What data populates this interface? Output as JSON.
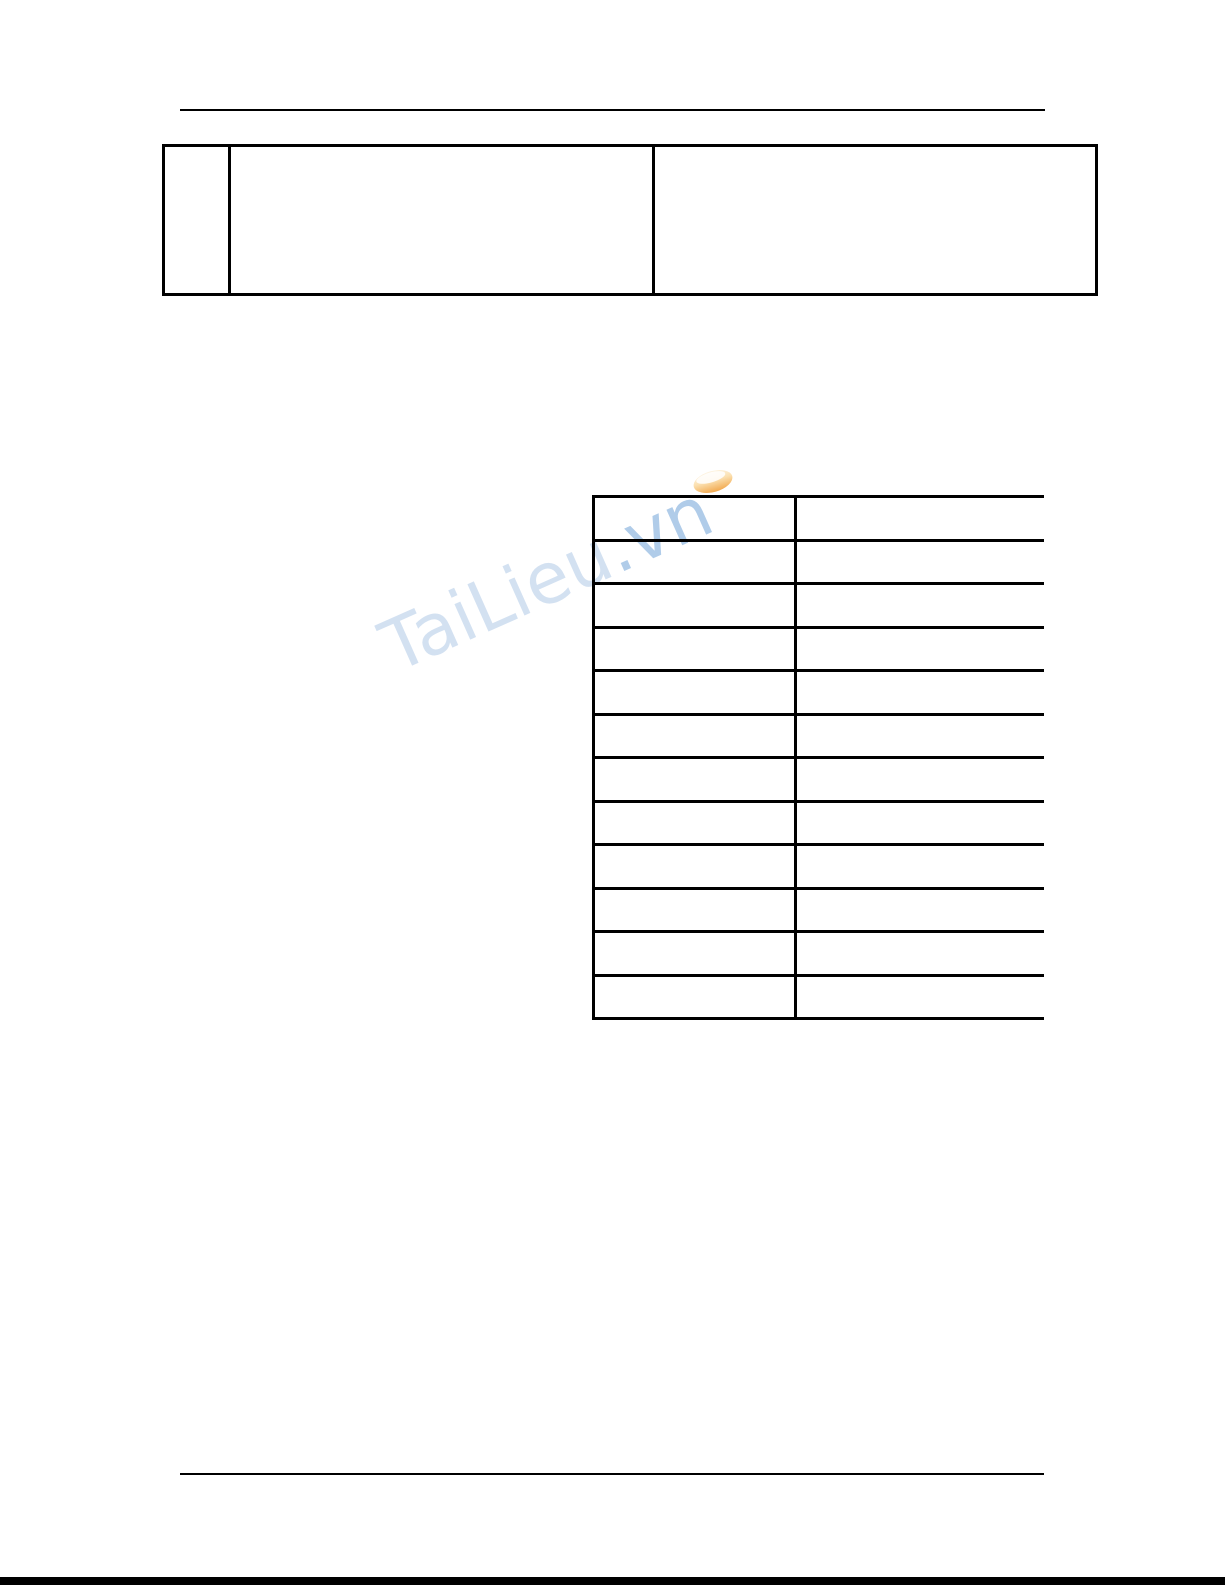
{
  "page": {
    "background": "#ffffff",
    "edge_bar_color": "#000000",
    "rule_color": "#000000"
  },
  "watermark": {
    "text": "TaiLieu.vn",
    "text_main": "TaiLieu",
    "text_suffix": ".vn",
    "color_main": "#c9daee",
    "color_suffix": "#9dc0e4",
    "logo_color": "#f2a94f",
    "rotation_deg": -24
  },
  "top_table": {
    "rows": 1,
    "columns": 3,
    "cells": [
      "",
      "",
      ""
    ]
  },
  "data_table": {
    "rows": 12,
    "columns": 2,
    "cells": [
      [
        "",
        ""
      ],
      [
        "",
        ""
      ],
      [
        "",
        ""
      ],
      [
        "",
        ""
      ],
      [
        "",
        ""
      ],
      [
        "",
        ""
      ],
      [
        "",
        ""
      ],
      [
        "",
        ""
      ],
      [
        "",
        ""
      ],
      [
        "",
        ""
      ],
      [
        "",
        ""
      ],
      [
        "",
        ""
      ]
    ]
  }
}
